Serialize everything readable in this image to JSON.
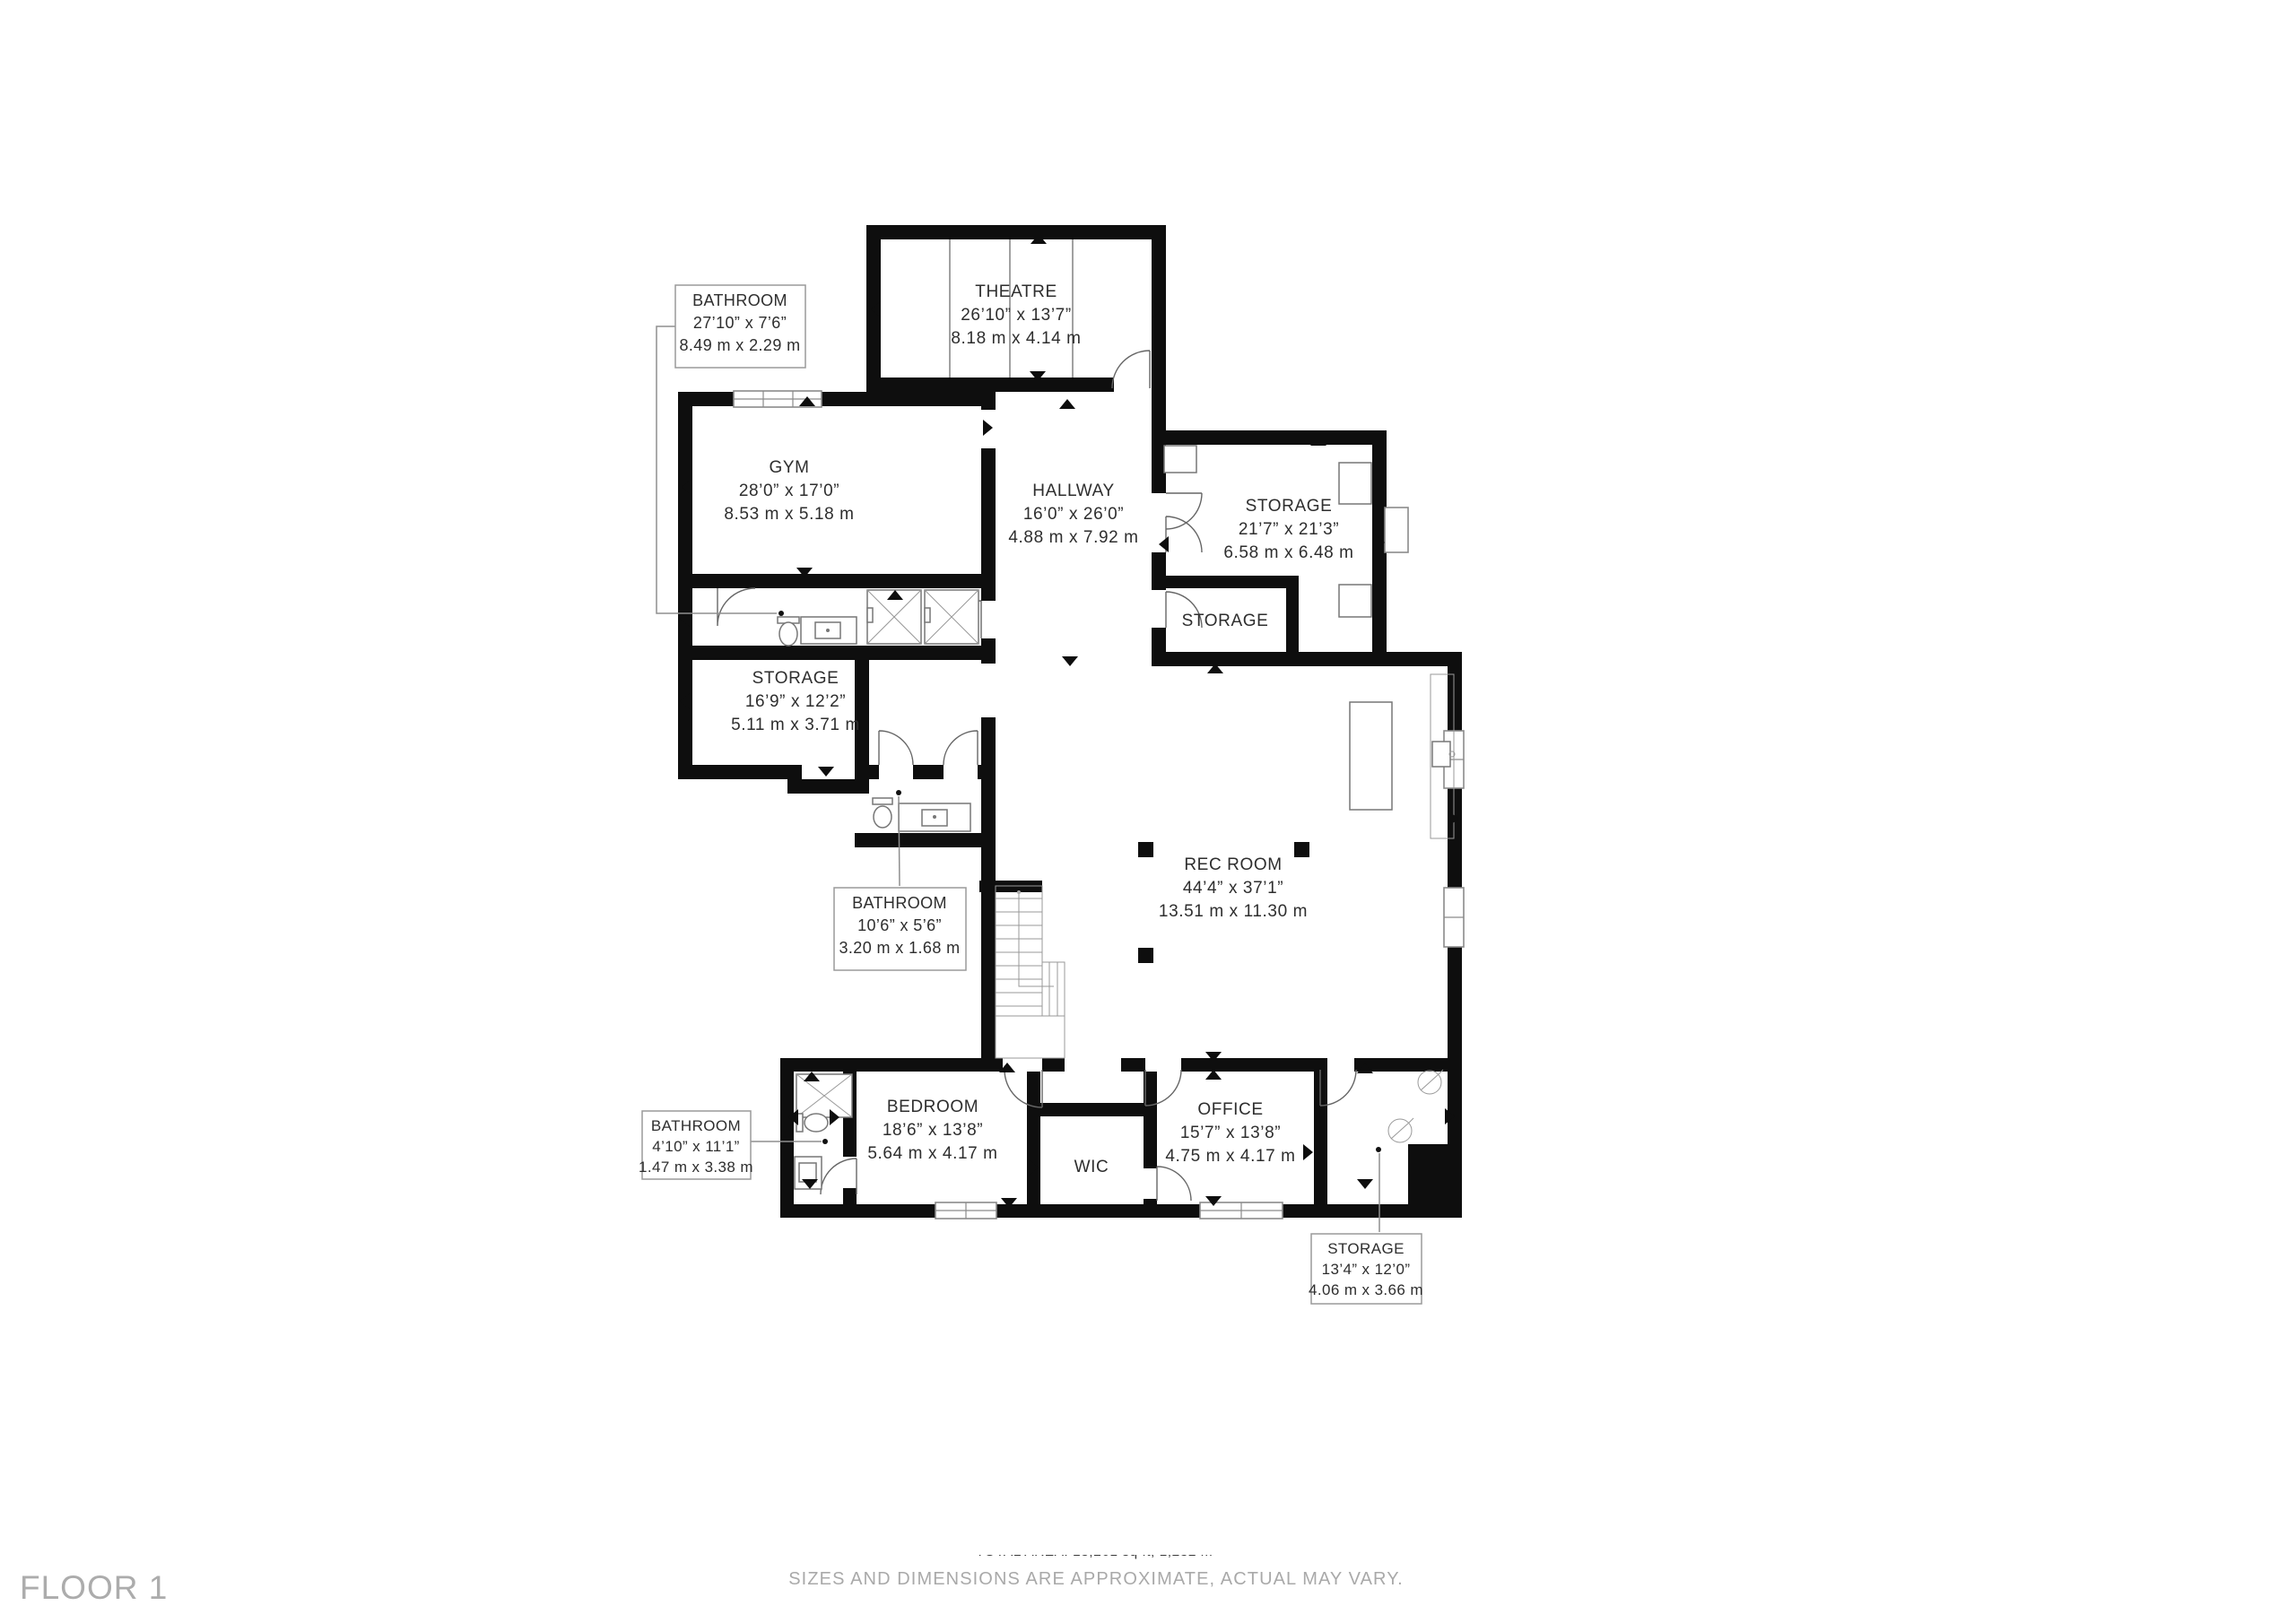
{
  "floor_label": "FLOOR 1",
  "rooms": {
    "theatre": {
      "name": "THEATRE",
      "dims_ft": "26’10” x 13’7”",
      "dims_m": "8.18 m x 4.14 m"
    },
    "gym": {
      "name": "GYM",
      "dims_ft": "28’0” x 17’0”",
      "dims_m": "8.53 m x 5.18 m"
    },
    "hallway": {
      "name": "HALLWAY",
      "dims_ft": "16’0” x 26’0”",
      "dims_m": "4.88 m x 7.92 m"
    },
    "storage_main": {
      "name": "STORAGE",
      "dims_ft": "21’7” x 21’3”",
      "dims_m": "6.58 m x 6.48 m"
    },
    "storage_inner": {
      "name": "STORAGE"
    },
    "storage_left": {
      "name": "STORAGE",
      "dims_ft": "16’9” x 12’2”",
      "dims_m": "5.11 m x 3.71 m"
    },
    "rec_room": {
      "name": "REC ROOM",
      "dims_ft": "44’4” x 37’1”",
      "dims_m": "13.51 m x 11.30 m"
    },
    "bedroom": {
      "name": "BEDROOM",
      "dims_ft": "18’6” x 13’8”",
      "dims_m": "5.64 m x 4.17 m"
    },
    "wic": {
      "name": "WIC"
    },
    "office": {
      "name": "OFFICE",
      "dims_ft": "15’7” x 13’8”",
      "dims_m": "4.75 m x 4.17 m"
    }
  },
  "callouts": {
    "bathroom_top": {
      "name": "BATHROOM",
      "dims_ft": "27’10” x 7’6”",
      "dims_m": "8.49 m x 2.29 m"
    },
    "bathroom_mid": {
      "name": "BATHROOM",
      "dims_ft": "10’6” x 5’6”",
      "dims_m": "3.20 m x 1.68 m"
    },
    "bathroom_lower": {
      "name": "BATHROOM",
      "dims_ft": "4’10” x 11’1”",
      "dims_m": "1.47 m x 3.38 m"
    },
    "storage_lower": {
      "name": "STORAGE",
      "dims_ft": "13’4” x 12’0”",
      "dims_m": "4.06 m x 3.66 m"
    }
  },
  "footer": {
    "total_area_line": "TOTAL AREA: 13,261 sq ft, 1,232 m",
    "disclaimer": "SIZES AND DIMENSIONS ARE APPROXIMATE, ACTUAL MAY VARY."
  },
  "colors": {
    "wall": "#0e0e0e",
    "label_text": "#2e2e2e",
    "muted_text": "#a9a9a9",
    "fixture_line": "#8a8a8a"
  }
}
